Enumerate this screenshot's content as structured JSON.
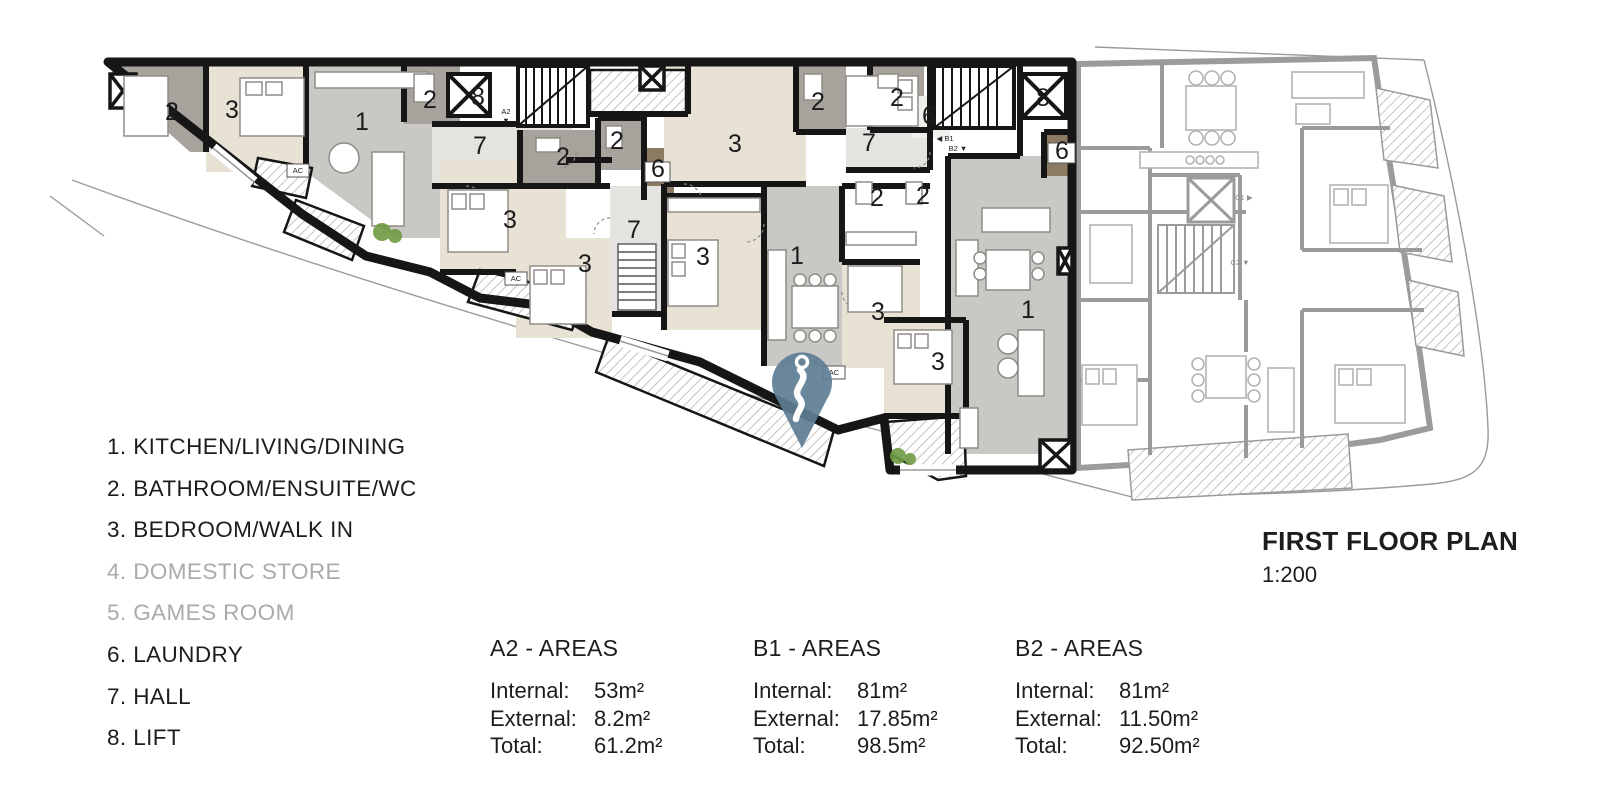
{
  "title_block": {
    "title": "FIRST FLOOR PLAN",
    "scale": "1:200"
  },
  "legend": {
    "items": [
      {
        "text": "1. KITCHEN/LIVING/DINING",
        "muted": false
      },
      {
        "text": "2. BATHROOM/ENSUITE/WC",
        "muted": false
      },
      {
        "text": "3. BEDROOM/WALK IN",
        "muted": false
      },
      {
        "text": "4. DOMESTIC STORE",
        "muted": true
      },
      {
        "text": "5. GAMES ROOM",
        "muted": true
      },
      {
        "text": "6. LAUNDRY",
        "muted": false
      },
      {
        "text": "7. HALL",
        "muted": false
      },
      {
        "text": "8. LIFT",
        "muted": false
      }
    ]
  },
  "area_tables": [
    {
      "unit": "A2 - AREAS",
      "internal_label": "Internal:",
      "internal_value": "53m²",
      "external_label": "External:",
      "external_value": "8.2m²",
      "total_label": "Total:",
      "total_value": "61.2m²"
    },
    {
      "unit": "B1 - AREAS",
      "internal_label": "Internal:",
      "internal_value": "81m²",
      "external_label": "External:",
      "external_value": "17.85m²",
      "total_label": "Total:",
      "total_value": "98.5m²"
    },
    {
      "unit": "B2 - AREAS",
      "internal_label": "Internal:",
      "internal_value": "81m²",
      "external_label": "External:",
      "external_value": "11.50m²",
      "total_label": "Total:",
      "total_value": "92.50m²"
    }
  ],
  "plan": {
    "room_labels": [
      {
        "t": "2",
        "x": 172,
        "y": 120
      },
      {
        "t": "3",
        "x": 232,
        "y": 118
      },
      {
        "t": "1",
        "x": 362,
        "y": 130
      },
      {
        "t": "2",
        "x": 430,
        "y": 108
      },
      {
        "t": "8",
        "x": 478,
        "y": 105
      },
      {
        "t": "7",
        "x": 480,
        "y": 154
      },
      {
        "t": "2",
        "x": 563,
        "y": 165
      },
      {
        "t": "2",
        "x": 617,
        "y": 149
      },
      {
        "t": "6",
        "x": 658,
        "y": 177
      },
      {
        "t": "3",
        "x": 510,
        "y": 228
      },
      {
        "t": "3",
        "x": 585,
        "y": 272
      },
      {
        "t": "7",
        "x": 634,
        "y": 238
      },
      {
        "t": "3",
        "x": 735,
        "y": 152
      },
      {
        "t": "3",
        "x": 703,
        "y": 265
      },
      {
        "t": "1",
        "x": 797,
        "y": 264
      },
      {
        "t": "2",
        "x": 818,
        "y": 110
      },
      {
        "t": "2",
        "x": 897,
        "y": 106
      },
      {
        "t": "7",
        "x": 869,
        "y": 151
      },
      {
        "t": "6",
        "x": 929,
        "y": 124
      },
      {
        "t": "8",
        "x": 1043,
        "y": 106
      },
      {
        "t": "6",
        "x": 1062,
        "y": 159
      },
      {
        "t": "2",
        "x": 877,
        "y": 206
      },
      {
        "t": "2",
        "x": 923,
        "y": 204
      },
      {
        "t": "3",
        "x": 878,
        "y": 320
      },
      {
        "t": "3",
        "x": 938,
        "y": 370
      },
      {
        "t": "1",
        "x": 1028,
        "y": 318
      }
    ],
    "marker_labels": [
      {
        "t": "A2",
        "x": 506,
        "y": 114,
        "gray": false
      },
      {
        "t": "▼",
        "x": 506,
        "y": 123,
        "gray": false
      },
      {
        "t": "◀ B1",
        "x": 945,
        "y": 141,
        "gray": false
      },
      {
        "t": "B2 ▼",
        "x": 958,
        "y": 151,
        "gray": false
      },
      {
        "t": "C1 ▶",
        "x": 1244,
        "y": 200,
        "gray": true
      },
      {
        "t": "C2 ▼",
        "x": 1240,
        "y": 265,
        "gray": true
      },
      {
        "t": "AC",
        "x": 298,
        "y": 173,
        "gray": false
      },
      {
        "t": "AC",
        "x": 516,
        "y": 281,
        "gray": false
      },
      {
        "t": "AC",
        "x": 834,
        "y": 375,
        "gray": false
      }
    ],
    "colors": {
      "wall": "#161616",
      "gray_wall": "#9b9b9b",
      "bedroom": "#e8e2d5",
      "living": "#c9c8c4",
      "bathroom": "#a7a29b",
      "hall": "#e4e3df",
      "laundry": "#8d7a62",
      "pin": "#5d7d94",
      "bush": "#6f9a43"
    }
  }
}
